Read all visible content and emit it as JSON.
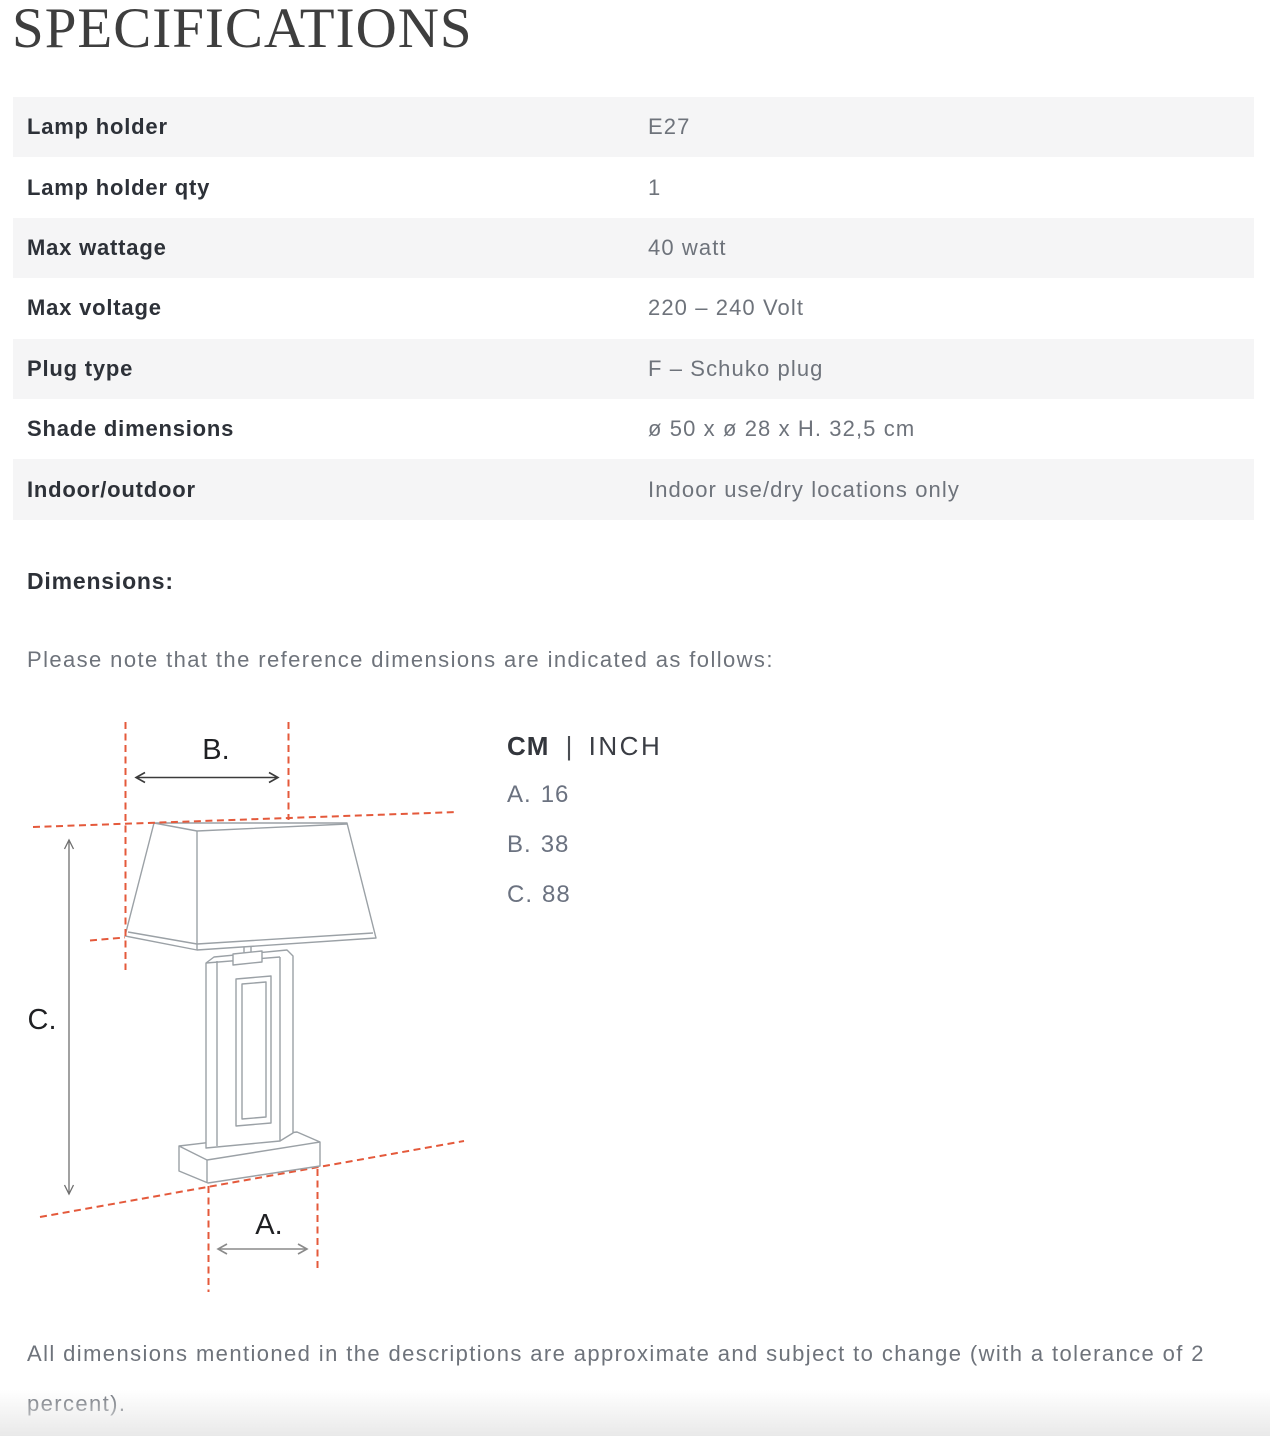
{
  "title": "SPECIFICATIONS",
  "spec_table": {
    "rows": [
      {
        "label": "Lamp holder",
        "value": "E27"
      },
      {
        "label": "Lamp holder qty",
        "value": "1"
      },
      {
        "label": "Max wattage",
        "value": "40 watt"
      },
      {
        "label": "Max voltage",
        "value": "220 – 240 Volt"
      },
      {
        "label": "Plug type",
        "value": "F – Schuko plug"
      },
      {
        "label": "Shade dimensions",
        "value": "ø 50 x ø 28 x H. 32,5 cm"
      },
      {
        "label": "Indoor/outdoor",
        "value": "Indoor use/dry locations only"
      }
    ]
  },
  "dimensions_section": {
    "heading": "Dimensions:",
    "note": "Please note that the reference dimensions are indicated as follows:",
    "legend": {
      "unit_primary": "CM",
      "separator": "|",
      "unit_secondary": "INCH",
      "entries": [
        {
          "key": "A.",
          "value": "16"
        },
        {
          "key": "B.",
          "value": "38"
        },
        {
          "key": "C.",
          "value": "88"
        }
      ]
    },
    "diagram": {
      "label_a": "A.",
      "label_b": "B.",
      "label_c": "C."
    }
  },
  "footer": {
    "disclaimer": "All dimensions mentioned in the descriptions are approximate and subject to change (with a tolerance of 2 percent)."
  },
  "colors": {
    "reference_line": "#e4593b",
    "drawing_line": "#9ba1a6",
    "row_background": "#f5f5f6",
    "label_text": "#2d3138",
    "value_text": "#6e737b"
  }
}
